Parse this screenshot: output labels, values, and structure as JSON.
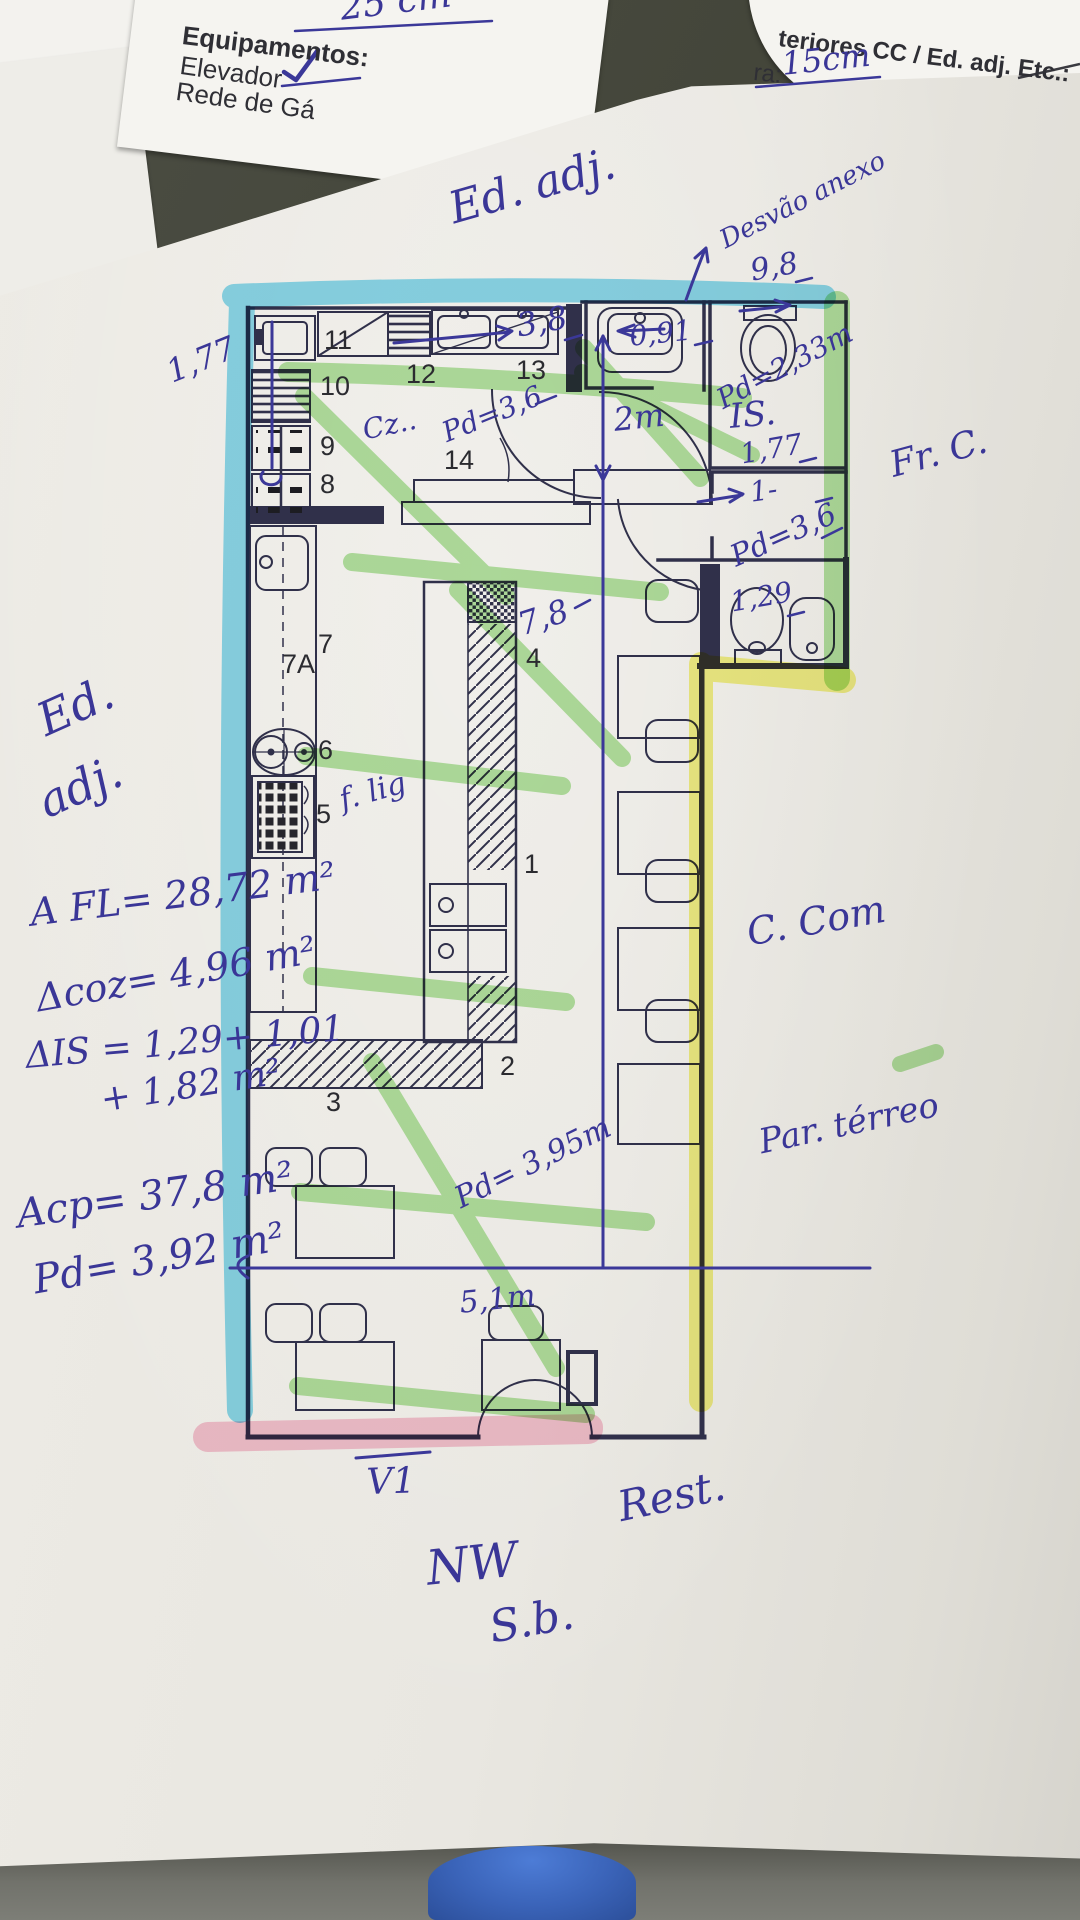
{
  "colors": {
    "cyan_highlighter": "#2fc0e8",
    "green_highlighter": "#79d25a",
    "yellow_highlighter": "#f0ec3c",
    "pink_highlighter": "#f7afc8",
    "blue_pen": "#3b3899",
    "plan_ink": "#30304a",
    "paper": "#e9e7e1"
  },
  "background_sheets": {
    "top_left": {
      "measure": "25 cm",
      "line1": "Equipamentos:",
      "line2": "Elevador",
      "line3": "Rede de Gá",
      "checkmark_icon": "check"
    },
    "top_right": {
      "line1": "teriores CC / Ed. adj. Etc.:",
      "label": "ra:",
      "measure": "15cm"
    }
  },
  "plan": {
    "room_numbers": {
      "n1": "1",
      "n2": "2",
      "n3": "3",
      "n4": "4",
      "n5": "5",
      "n6": "6",
      "n7": "7",
      "n7a": "7A",
      "n8": "8",
      "n9": "9",
      "n10": "10",
      "n11": "11",
      "n12": "12",
      "n13": "13",
      "n14": "14"
    },
    "annotations": {
      "ed_adj_top": "Ed. adj.",
      "desvao_anexo": "Desvão anexo",
      "dim_9_8": "9,8",
      "dim_1_77_left": "1,77",
      "cz": "Cz..",
      "pd_3_6_top": "Pd=3,6",
      "dim_3_8": "3,8",
      "dim_0_91": "0,91",
      "pd_2_33": "Pd=2,33m",
      "dim_2m": "2m",
      "is_label": "IS.",
      "dim_1_77_room": "1,77",
      "one_dash": "1-",
      "pd_3_6_right": "Pd=3,6",
      "dim_1_29": "1,29",
      "dim_7_8": "7,8",
      "f_lig": "f. lig",
      "ed_left_1": "Ed.",
      "ed_left_2": "adj.",
      "a_fl": "A FL= 28,72 m²",
      "a_coz": "Δcoz= 4,96 m²",
      "a_is": "ΔIS = 1,29+ 1,01",
      "a_is2": "+ 1,82 m²",
      "a_cp": "Acp= 37,8 m²",
      "pd_392": "Pd= 3,92 m²",
      "fr_c": "Fr. C.",
      "c_com": "C. Com",
      "par_terreo": "Par. térreo",
      "pd_395": "Pd= 3,95m",
      "dim_5_1m": "5,1m",
      "v1": "V1",
      "rest": "Rest.",
      "nw": "NW",
      "sb": "S.b."
    }
  }
}
